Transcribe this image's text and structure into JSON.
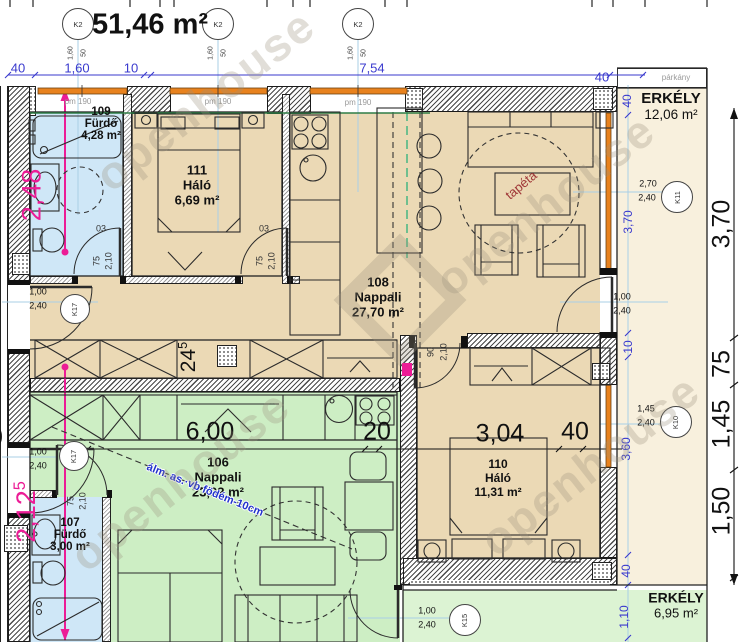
{
  "header": {
    "title": "51,46 m²",
    "grid_bubble": "K2",
    "grid_sub": {
      "a": "1,60",
      "b": "50"
    },
    "top_dims": [
      "40",
      "1,60",
      "10",
      "7,54",
      "40"
    ],
    "parkany": "párkány",
    "parapet": "pm 190"
  },
  "rooms": {
    "r109": {
      "num": "109",
      "name": "Fürdő",
      "area": "4,28 m²"
    },
    "r111": {
      "num": "111",
      "name": "Háló",
      "area": "6,69 m²"
    },
    "r108": {
      "num": "108",
      "name": "Nappali",
      "area": "27,70 m²"
    },
    "r106": {
      "num": "106",
      "name": "Nappali",
      "area": "23,02 m²"
    },
    "r107": {
      "num": "107",
      "name": "Fürdő",
      "area": "3,00 m²"
    },
    "r110": {
      "num": "110",
      "name": "Háló",
      "area": "11,31 m²"
    },
    "balcony_top": {
      "name": "ERKÉLY",
      "area": "12,06 m²"
    },
    "balcony_bottom": {
      "name": "ERKÉLY",
      "area": "6,95 m²"
    }
  },
  "doors": {
    "bath109": {
      "code": "03",
      "w": "75",
      "h": "2,10"
    },
    "bed111": {
      "code": "03",
      "w": "75",
      "h": "2,10"
    },
    "bed110": {
      "w": "90",
      "h": "2,10"
    },
    "bath107": {
      "w": "75",
      "h": "2,10"
    },
    "entry_upper": {
      "tag": "K17",
      "w": "1,00",
      "h": "2,40"
    },
    "entry_lower": {
      "tag": "K17",
      "w": "1,00",
      "h": "2,40"
    },
    "balcony_upper": {
      "w": "1,00",
      "h": "2,40"
    },
    "balcony_lower": {
      "tag": "K15",
      "w": "1,00",
      "h": "2,40"
    }
  },
  "windows": {
    "k11": {
      "tag": "K11",
      "w": "2,70",
      "h": "2,40"
    },
    "k10": {
      "tag": "K10",
      "w": "1,45",
      "h": "2,40"
    }
  },
  "dims": {
    "magenta_top": "2,48",
    "magenta_bottom": {
      "main": "2,12",
      "sup": "5"
    },
    "wall": {
      "main": "24",
      "sup": "5"
    },
    "interior": [
      "6,00",
      "20",
      "3,04",
      "40"
    ],
    "right_black": [
      "3,70",
      "75",
      "1,45",
      "1,50"
    ],
    "right_blue": [
      "40",
      "3,70",
      "10",
      "3,60",
      "40",
      "1,10"
    ],
    "edge_clip": "0"
  },
  "notes": {
    "slab": "álm. as.·vb födém-10cm",
    "wallpaper": "tapéta",
    "watermark": "openhouse"
  }
}
